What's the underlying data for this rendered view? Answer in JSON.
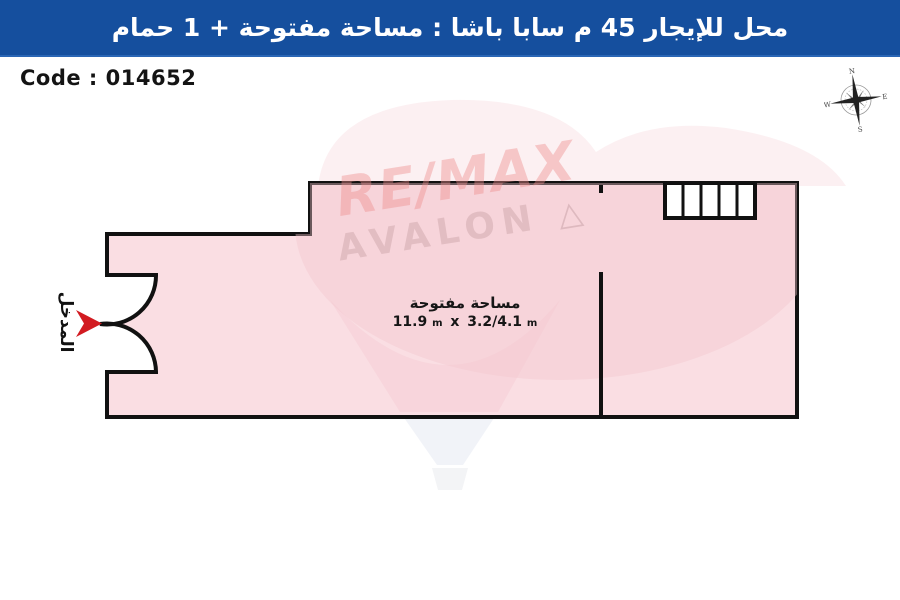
{
  "header": {
    "title": "محل للإيجار 45 م سابا باشا :  مساحة مفتوحة + 1 حمام",
    "bg_color": "#154f9e"
  },
  "code": {
    "label": "Code : 014652"
  },
  "compass": {
    "n": "N",
    "e": "E",
    "s": "S",
    "w": "W"
  },
  "watermark": {
    "line1": "RE/MAX",
    "line2": "AVALON",
    "mark": "△"
  },
  "plan": {
    "room_label": "مساحة مفتوحة",
    "dimensions": {
      "value1": "11.9",
      "unit1": "m",
      "times": "x",
      "value2": "3.2/4.1",
      "unit2": "m"
    },
    "entrance_label": "المدخل",
    "colors": {
      "fill": "#fadee3",
      "wall": "#111111",
      "arrow": "#d21b21"
    }
  }
}
